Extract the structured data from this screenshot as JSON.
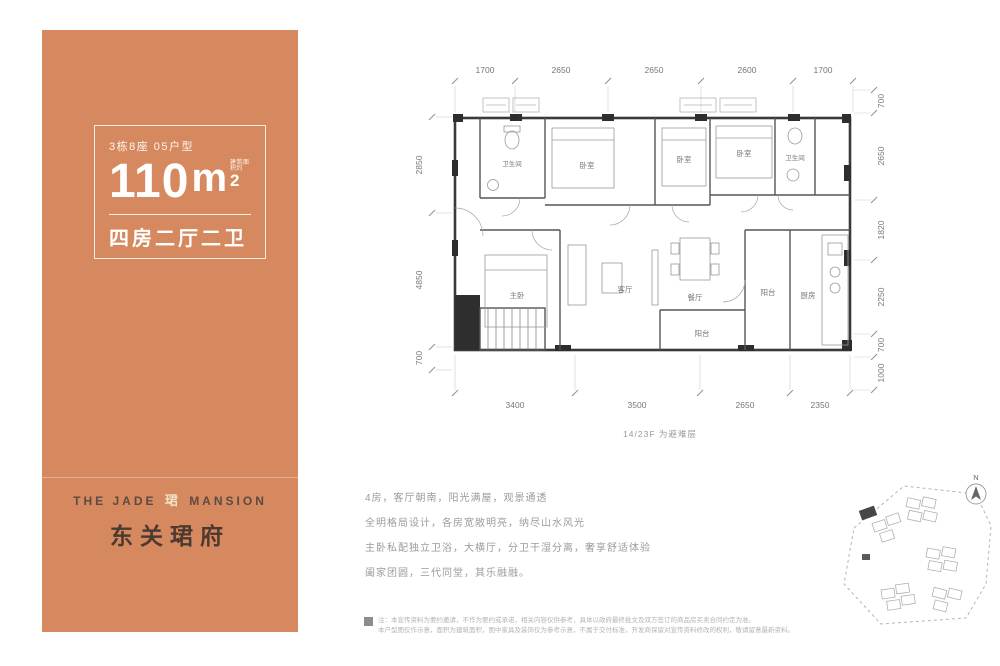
{
  "left_panel": {
    "bg_color": "#d6895e",
    "unit_tag": "3栋8座 05户型",
    "area_value": "110",
    "area_unit": "m",
    "area_sup": "2",
    "area_note": "建筑面积约",
    "layout": "四房二厅二卫",
    "brand_en_left": "THE JADE",
    "brand_glyph": "珺",
    "brand_en_right": "MANSION",
    "brand_cn": "东关珺府"
  },
  "floorplan": {
    "dims_top": [
      "1700",
      "2650",
      "2650",
      "2600",
      "1700"
    ],
    "dims_right": [
      "700",
      "2650",
      "1820",
      "2250",
      "700",
      "1000"
    ],
    "dims_left": [
      "2850",
      "4850",
      "700"
    ],
    "dims_bottom": [
      "3400",
      "3500",
      "2650",
      "2350"
    ],
    "note": "14/23F 为避难层",
    "rooms": {
      "bath1": "卫生间",
      "bed2": "卧室",
      "bed3": "卧室",
      "bed4": "卧室",
      "bath2": "卫生间",
      "kitchen": "厨房",
      "master": "主卧",
      "living": "客厅",
      "dining": "餐厅",
      "balcony_right": "阳台",
      "balcony_bottom": "阳台"
    }
  },
  "description": {
    "line1": "4房，客厅朝南，阳光满屋，观景通透",
    "line2": "全明格局设计，各房宽敞明亮，纳尽山水风光",
    "line3": "主卧私配独立卫浴，大横厅，分卫干湿分离，奢享舒适体验",
    "line4": "阖家团圆，三代同堂，其乐融融。"
  },
  "disclaimer": {
    "line1": "注：本宣传资料为要约邀请，不作为要约或承诺，相关内容仅供参考，具体以政府最终批文及双方签订的商品房买卖合同约定为准。",
    "line2": "本户型图仅作示意，面积为建筑面积，图中家具及装饰仅为参考示意，不属于交付标准，开发商保留对宣传资料修改的权利，敬请留意最新资料。"
  },
  "siteplan": {
    "compass": "N"
  }
}
